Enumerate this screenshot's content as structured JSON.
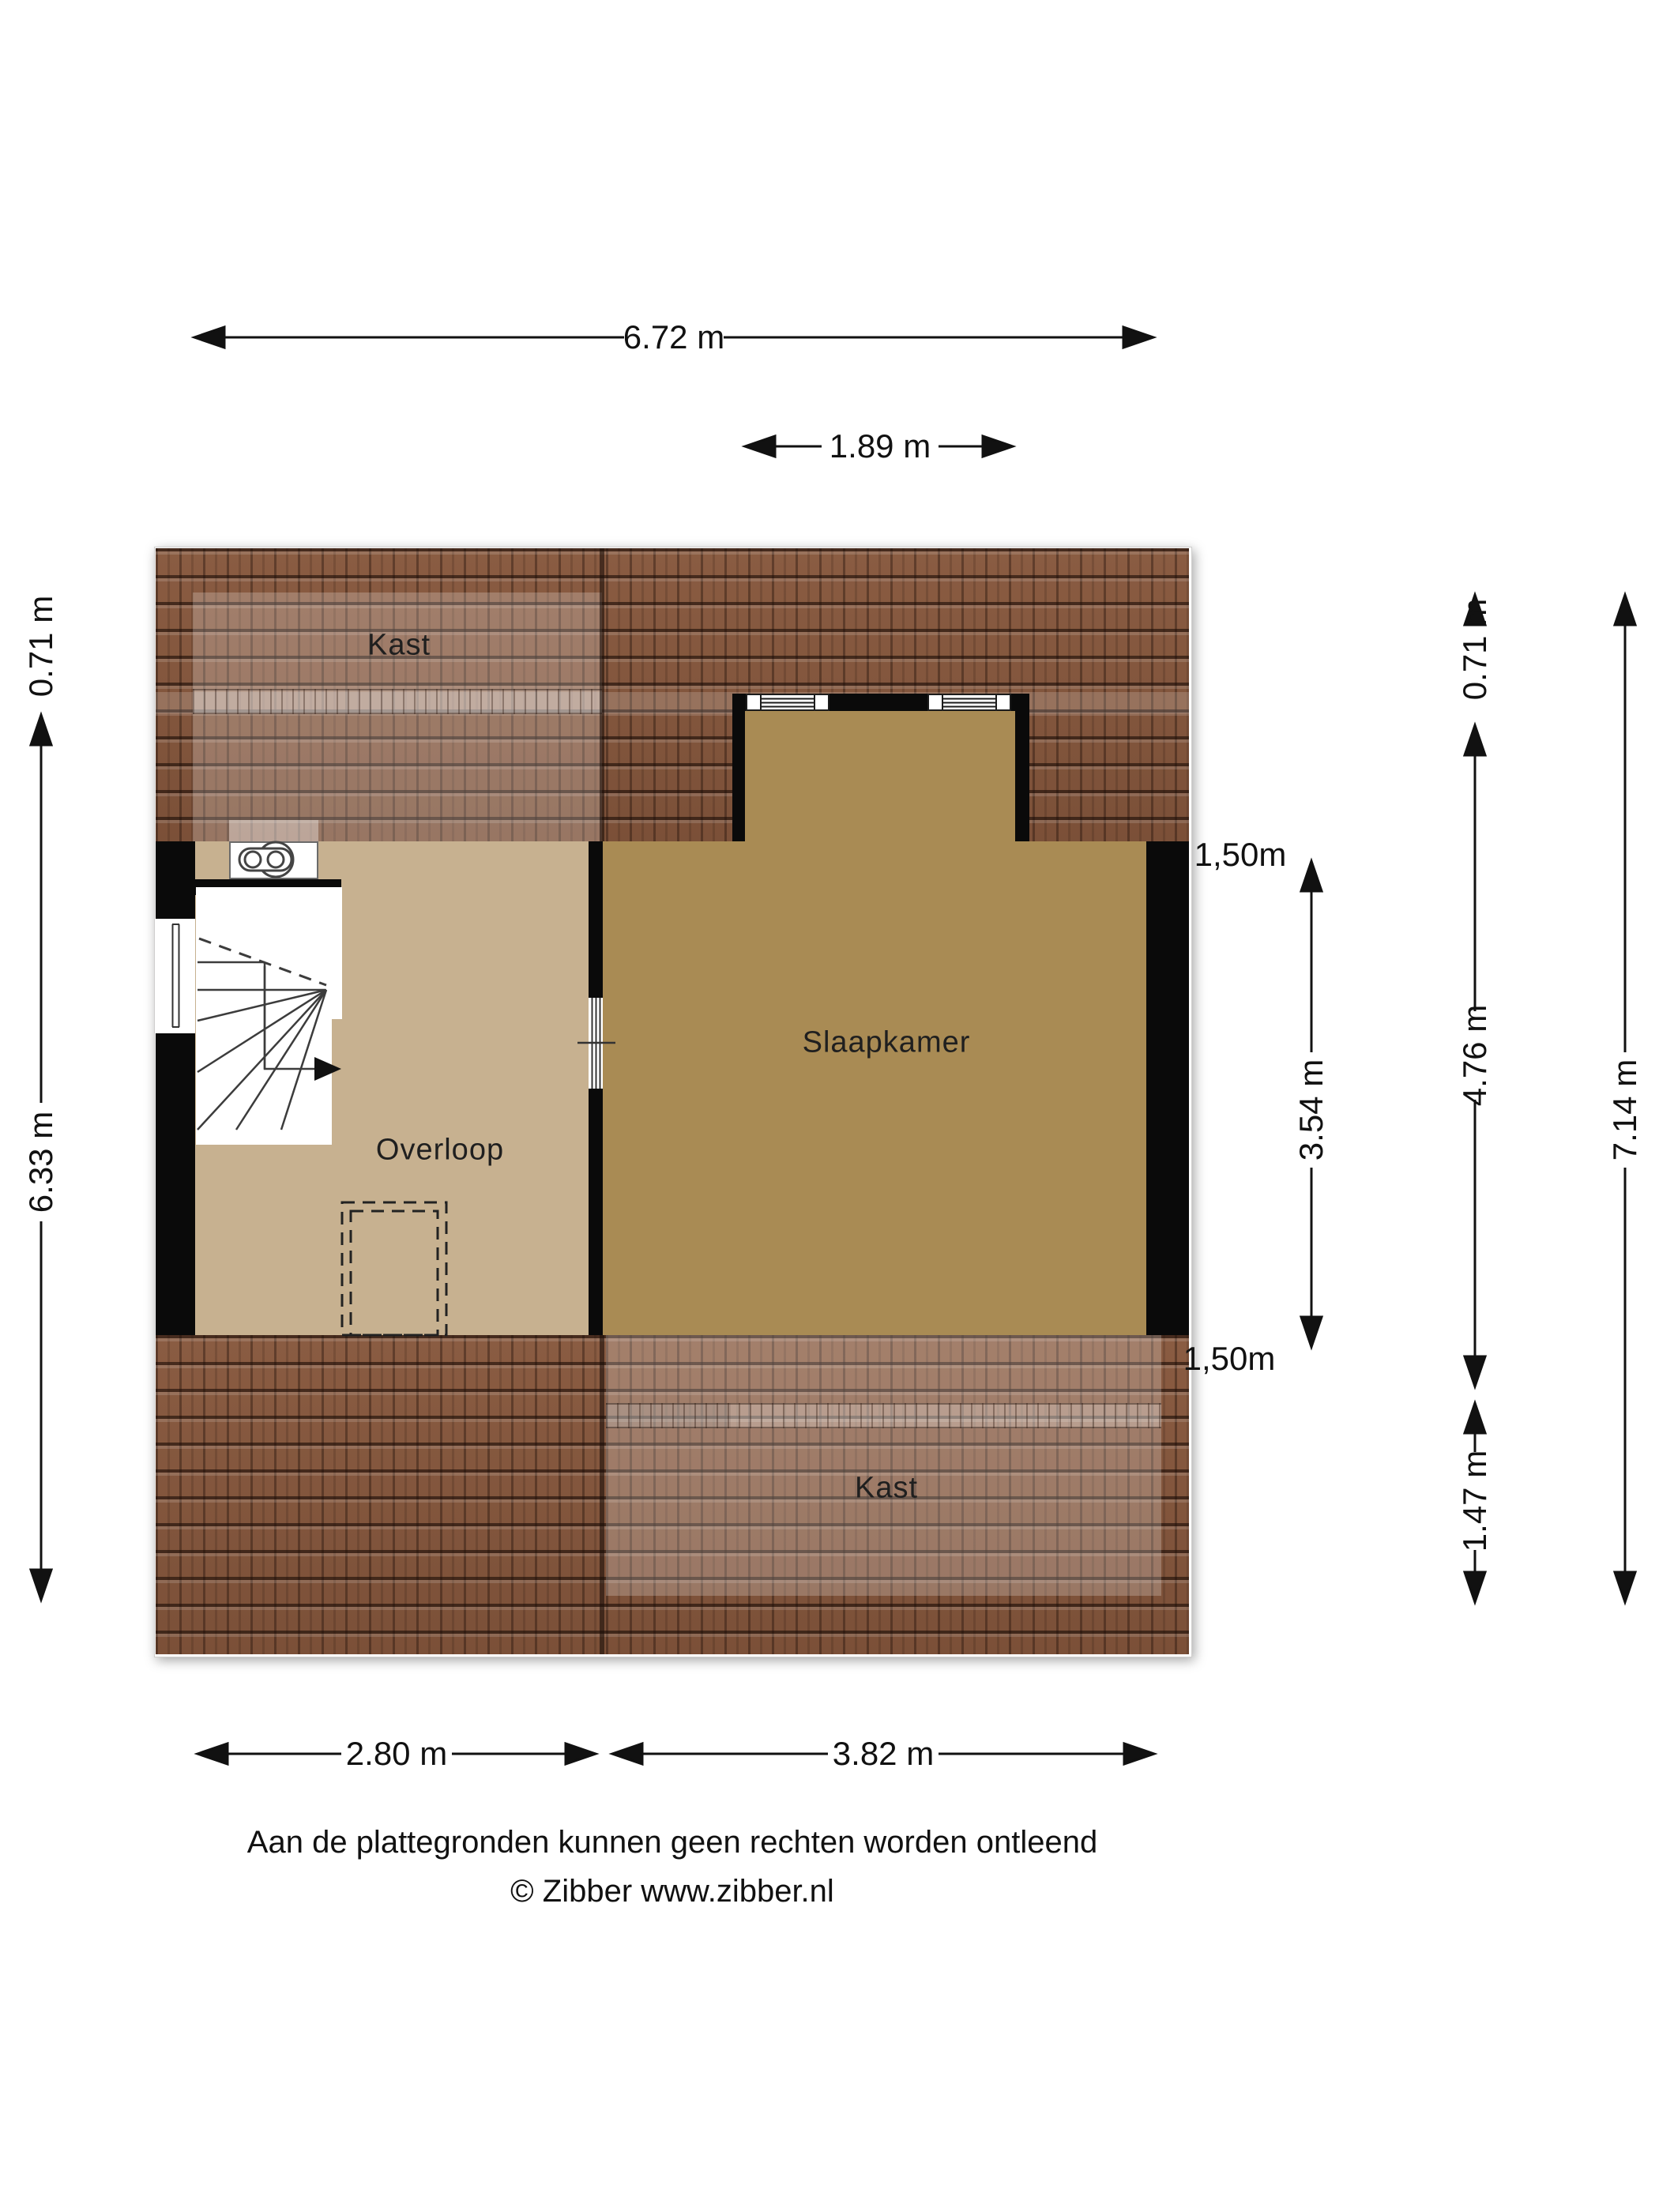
{
  "plan": {
    "rooms": {
      "kast_top": "Kast",
      "slaapkamer": "Slaapkamer",
      "overloop": "Overloop",
      "kast_bottom": "Kast"
    }
  },
  "dimensions": {
    "top_width": "6.72 m",
    "dormer_width": "1.89 m",
    "left_eave": "0.71 m",
    "left_height": "6.33 m",
    "knee_wall_top": "1,50m",
    "bedroom_depth": "3.54 m",
    "knee_wall_bottom": "1,50m",
    "right_eave": "0.71 m",
    "right_main": "4.76 m",
    "right_lower": "1.47 m",
    "right_total": "7.14 m",
    "bottom_left": "2.80 m",
    "bottom_right": "3.82 m"
  },
  "footer": {
    "disclaimer": "Aan de plattegronden kunnen geen rechten worden ontleend",
    "copyright": "© Zibber www.zibber.nl"
  },
  "colors": {
    "roof_tile": "#84573f",
    "floor_overloop": "#c7b190",
    "floor_slaapkamer": "#a98b54",
    "wall": "#0a0a0a",
    "dimension_ink": "#111111"
  }
}
